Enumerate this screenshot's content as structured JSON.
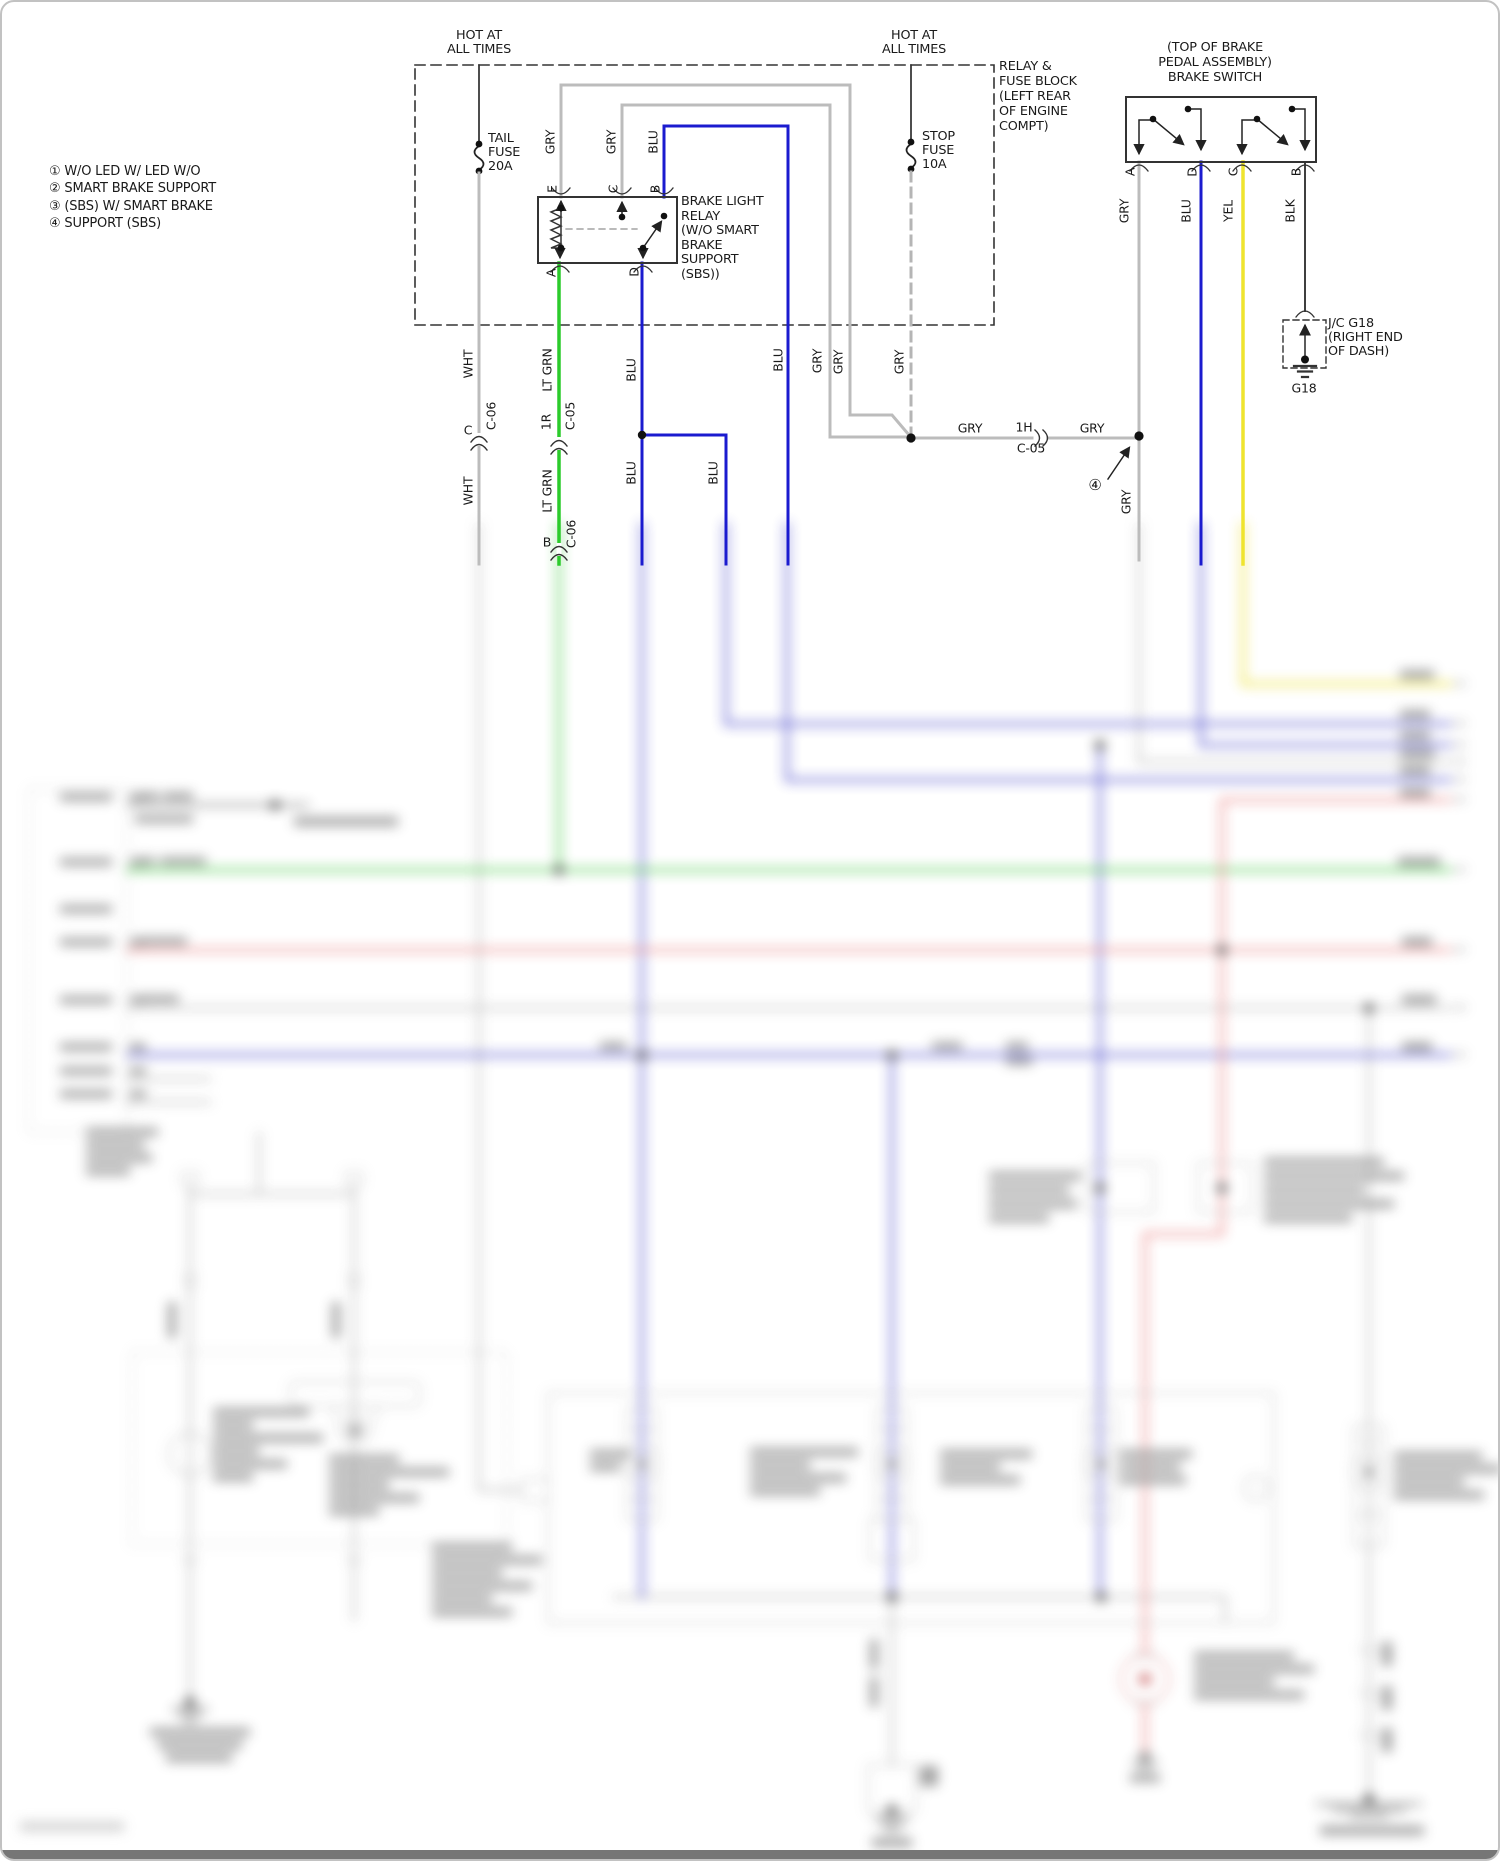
{
  "colors": {
    "wire_gray": "#bcbcbc",
    "wire_white": "#c9c9c9",
    "wire_blue": "#1b1bcf",
    "wire_green": "#2bcb2b",
    "wire_yellow": "#efe42e",
    "wire_black": "#3f3f3f",
    "wire_red": "#ec8f8f",
    "text": "#1a1a1a"
  },
  "legend": {
    "items": [
      "① W/O LED W/ LED W/O",
      "② SMART BRAKE SUPPORT",
      "③ (SBS) W/ SMART BRAKE",
      "④ SUPPORT (SBS)"
    ]
  },
  "blocks": [
    {
      "name": "hot-at-times-1",
      "align": "center",
      "x": 477,
      "y": 27,
      "lh": 13.5,
      "fs": 12.8,
      "lines": [
        "HOT AT",
        "ALL TIMES"
      ]
    },
    {
      "name": "tail-fuse-label",
      "align": "left",
      "x": 486,
      "y": 130,
      "lh": 14,
      "fs": 12.8,
      "lines": [
        "TAIL",
        "FUSE",
        "20A"
      ]
    },
    {
      "name": "hot-at-times-2",
      "align": "center",
      "x": 912,
      "y": 27,
      "lh": 13.5,
      "fs": 12.8,
      "lines": [
        "HOT AT",
        "ALL TIMES"
      ]
    },
    {
      "name": "stop-fuse-label",
      "align": "left",
      "x": 920,
      "y": 128,
      "lh": 14,
      "fs": 12.8,
      "lines": [
        "STOP",
        "FUSE",
        "10A"
      ]
    },
    {
      "name": "relay-fuse-block-label",
      "align": "left",
      "x": 997,
      "y": 57,
      "lh": 15,
      "fs": 12.8,
      "lines": [
        "RELAY &",
        "FUSE BLOCK",
        "(LEFT REAR",
        "OF ENGINE",
        "COMPT)"
      ]
    },
    {
      "name": "brake-light-relay-label",
      "align": "left",
      "x": 679,
      "y": 193,
      "lh": 14.5,
      "fs": 12.8,
      "lines": [
        "BRAKE LIGHT",
        "RELAY",
        "(W/O SMART",
        "BRAKE",
        "SUPPORT",
        "(SBS))"
      ]
    },
    {
      "name": "brake-switch-title",
      "align": "center",
      "x": 1213,
      "y": 38,
      "lh": 15,
      "fs": 12.8,
      "lines": [
        "(TOP OF BRAKE",
        "PEDAL ASSEMBLY)",
        "BRAKE SWITCH"
      ]
    },
    {
      "name": "jc-g18-label",
      "align": "left",
      "x": 1326,
      "y": 315,
      "lh": 14,
      "fs": 12.8,
      "lines": [
        "J/C G18",
        "(RIGHT END",
        "OF DASH)"
      ]
    },
    {
      "name": "variant-legend",
      "align": "left",
      "x": 47,
      "y": 161,
      "lh": 17.3,
      "fs": 13,
      "lines": [
        "① W/O LED W/ LED W/O",
        "② SMART BRAKE SUPPORT",
        "③ (SBS) W/ SMART BRAKE",
        "④ SUPPORT (SBS)"
      ]
    }
  ],
  "wire_labels": [
    {
      "t": "GRY",
      "x": 548,
      "y": 140,
      "o": "v"
    },
    {
      "t": "GRY",
      "x": 609,
      "y": 140,
      "o": "v"
    },
    {
      "t": "BLU",
      "x": 651,
      "y": 140,
      "o": "v"
    },
    {
      "t": "WHT",
      "x": 466,
      "y": 362,
      "o": "v"
    },
    {
      "t": "LT GRN",
      "x": 545,
      "y": 368,
      "o": "v"
    },
    {
      "t": "BLU",
      "x": 629,
      "y": 368,
      "o": "v"
    },
    {
      "t": "WHT",
      "x": 466,
      "y": 489,
      "o": "v"
    },
    {
      "t": "LT GRN",
      "x": 545,
      "y": 489,
      "o": "v"
    },
    {
      "t": "BLU",
      "x": 629,
      "y": 471,
      "o": "v"
    },
    {
      "t": "BLU",
      "x": 711,
      "y": 471,
      "o": "v"
    },
    {
      "t": "BLU",
      "x": 776,
      "y": 358,
      "o": "v"
    },
    {
      "t": "GRY",
      "x": 815,
      "y": 359,
      "o": "v"
    },
    {
      "t": "GRY",
      "x": 836,
      "y": 360,
      "o": "v"
    },
    {
      "t": "GRY",
      "x": 897,
      "y": 360,
      "o": "v"
    },
    {
      "t": "GRY",
      "x": 1122,
      "y": 209,
      "o": "v"
    },
    {
      "t": "BLU",
      "x": 1184,
      "y": 209,
      "o": "v"
    },
    {
      "t": "YEL",
      "x": 1226,
      "y": 209,
      "o": "v"
    },
    {
      "t": "BLK",
      "x": 1288,
      "y": 209,
      "o": "v"
    },
    {
      "t": "GRY",
      "x": 1124,
      "y": 500,
      "o": "v"
    },
    {
      "t": "C-06",
      "x": 489,
      "y": 414,
      "o": "v"
    },
    {
      "t": "C-05",
      "x": 568,
      "y": 414,
      "o": "v"
    },
    {
      "t": "1R",
      "x": 544,
      "y": 420,
      "o": "v"
    },
    {
      "t": "C-06",
      "x": 569,
      "y": 532,
      "o": "v"
    },
    {
      "t": "C",
      "x": 466,
      "y": 428,
      "o": "h"
    },
    {
      "t": "B",
      "x": 545,
      "y": 540,
      "o": "h"
    },
    {
      "t": "GRY",
      "x": 968,
      "y": 426,
      "o": "h"
    },
    {
      "t": "1H",
      "x": 1022,
      "y": 425,
      "o": "h"
    },
    {
      "t": "C-05",
      "x": 1029,
      "y": 446,
      "o": "h"
    },
    {
      "t": "GRY",
      "x": 1090,
      "y": 426,
      "o": "h"
    },
    {
      "t": "G18",
      "x": 1302,
      "y": 386,
      "o": "h"
    },
    {
      "t": "④",
      "x": 1093,
      "y": 483,
      "o": "h",
      "fs": 15
    },
    {
      "t": "E",
      "x": 550,
      "y": 187,
      "o": "v"
    },
    {
      "t": "C",
      "x": 611,
      "y": 187,
      "o": "v"
    },
    {
      "t": "B",
      "x": 653,
      "y": 187,
      "o": "v"
    },
    {
      "t": "A",
      "x": 549,
      "y": 271,
      "o": "v"
    },
    {
      "t": "D",
      "x": 632,
      "y": 270,
      "o": "v"
    },
    {
      "t": "A",
      "x": 1128,
      "y": 170,
      "o": "v"
    },
    {
      "t": "D",
      "x": 1190,
      "y": 170,
      "o": "v"
    },
    {
      "t": "C",
      "x": 1231,
      "y": 170,
      "o": "v"
    },
    {
      "t": "B",
      "x": 1294,
      "y": 170,
      "o": "v"
    }
  ]
}
